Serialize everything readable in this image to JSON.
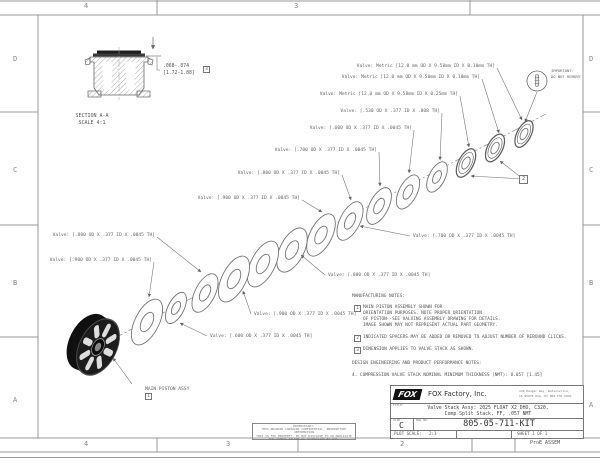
{
  "colors": {
    "paper": "#ffffff",
    "line": "#777777",
    "ink": "#555555",
    "dark": "#1c1c1c"
  },
  "sheet": {
    "zones_top": [
      "4",
      "3"
    ],
    "zones_bottom": [
      "4",
      "3",
      "2"
    ],
    "zones_left": [
      "D",
      "C",
      "B",
      "A"
    ],
    "zones_right": [
      "D",
      "C",
      "B",
      "A"
    ]
  },
  "section_view": {
    "label_line1": "SECTION A-A",
    "label_line2": "SCALE 4:1",
    "dimension_in": ".068-.074",
    "dimension_mm": "[1.72-1.88]"
  },
  "flags": {
    "piston": "1",
    "spacers": "2",
    "dimension": "3"
  },
  "callouts": [
    "Valve: Metric [12.0 mm OD X 9.58mm ID X 0.10mm TH]",
    "Valve: Metric [12.0 mm OD X 9.58mm ID X 0.10mm TH]",
    "Valve: Metric [12.0 mm OD X 9.58mm ID X 0.25mm TH]",
    "Valve: [.530 OD X .377 ID X .008 TH]",
    "Valve: [.600 OD X .377 ID X .0045 TH]",
    "Valve: [.700 OD X .377 ID X .0045 TH]",
    "Valve: [.800 OD X .377 ID X .0045 TH]",
    "Valve: [.900 OD X .377 ID X .0045 TH]",
    "Valve: [.800 OD X .377 ID X .0045 TH]",
    "Valve: [.900 OD X .377 ID X .0045 TH]",
    "Valve: [.600 OD X .377 ID X .0045 TH]",
    "Valve: [.700 OD X .377 ID X .0045 TH]",
    "Valve: [.800 OD X .377 ID X .0045 TH]",
    "Valve: [.900 OD X .377 ID X .0045 TH]"
  ],
  "piston_label": "MAIN PISTON ASSY",
  "important_note": {
    "line1": "IMPORTANT:",
    "line2": "DO NOT REMOVE"
  },
  "notes": {
    "mfg_header": "MANUFACTURING NOTES:",
    "n1_l1": "MAIN PISTON ASSEMBLY SHOWN FOR",
    "n1_l2": "ORIENTATION PURPOSES. NOTE PROPER ORIENTATION",
    "n1_l3": "OF PISTON--SEE VALVING ASSEMBLY DRAWING FOR DETAILS.",
    "n1_l4": "IMAGE SHOWN MAY NOT REPRESENT ACTUAL PART GEOMETRY.",
    "n2": "INDICATED SPACERS MAY BE ADDED OR REMOVED TO ADJUST NUMBER OF REBOUND CLICKS.",
    "n3": "DIMENSION APPLIES TO VALVE STACK AS SHOWN.",
    "design_header": "DESIGN ENGINEERING AND PRODUCT PERFORMANCE NOTES:",
    "n4": "4. COMPRESSION VALVE STACK NOMINAL MINIMUM THICKNESS (NMT): 0.057 [1.45]"
  },
  "title_block": {
    "logo": "FOX",
    "company": "FOX Factory, Inc.",
    "address_l1": "130 Hangar Way, Watsonville,",
    "address_l2": "CA 95076 USA  Ph 800-FOX-SHOX",
    "title_label": "TITLE:",
    "title_l1": "Valve Stack Assy: 2025 FLOAT X2 DHO, C320,",
    "title_l2": "Comp Split Stack, FF, .057 NMT",
    "size_label": "SIZE",
    "size": "C",
    "dwg_label": "DWG NO.",
    "dwg_no": "805-05-711-KIT",
    "scale_label": "PLOT SCALE:",
    "scale": "2:1",
    "sheet_label": "SHEET 1 OF 1"
  },
  "proprietary": {
    "l1": "PROPRIETARY:",
    "l2": "THIS DRAWING CONTAINS CONFIDENTIAL, PROPRIETARY INFORMATION",
    "l3": "THAT IS FOX PROPERTY. DO NOT DISCLOSE TO OR DUPLICATE",
    "l4": "FOR OTHERS EXCEPT AS AUTHORIZED BY FOX."
  },
  "footer": {
    "proe": "ProE ASSEM"
  }
}
